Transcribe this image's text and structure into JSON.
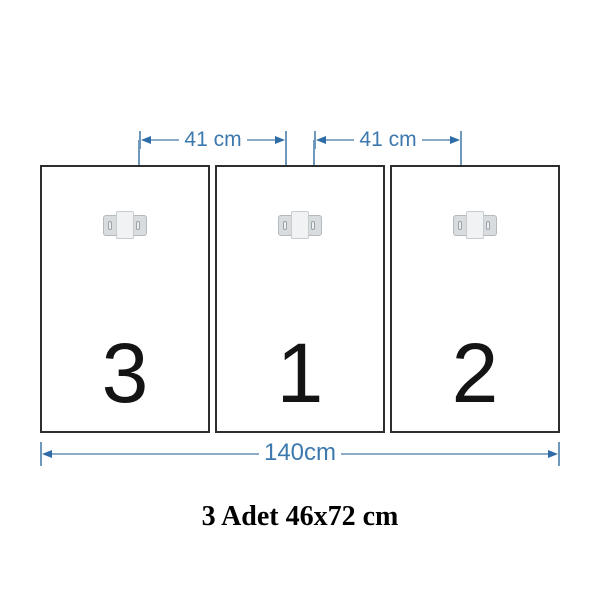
{
  "colors": {
    "dimension_text": "#3d79ae",
    "dimension_line": "#8cabc8",
    "dimension_tick": "#6e99bd",
    "dimension_arrow": "#2d6ca6",
    "drop_line": "#6e99bd",
    "panel_border": "#2e2e2e",
    "panel_number": "#141414",
    "bracket_wing": "#d9dcde",
    "bracket_wing_border": "#b3b9bc",
    "bracket_center": "#f1f2f3",
    "bracket_center_border": "#c7cccf",
    "slot_fill": "#eef0f1",
    "slot_border": "#9aa1a6",
    "caption_color": "#000000"
  },
  "panels": [
    {
      "label": "3"
    },
    {
      "label": "1"
    },
    {
      "label": "2"
    }
  ],
  "top_dimensions": [
    {
      "label": "41 cm"
    },
    {
      "label": "41 cm"
    }
  ],
  "bottom_dimension": {
    "label": "140cm"
  },
  "caption": {
    "text": "3 Adet 46x72 cm"
  }
}
